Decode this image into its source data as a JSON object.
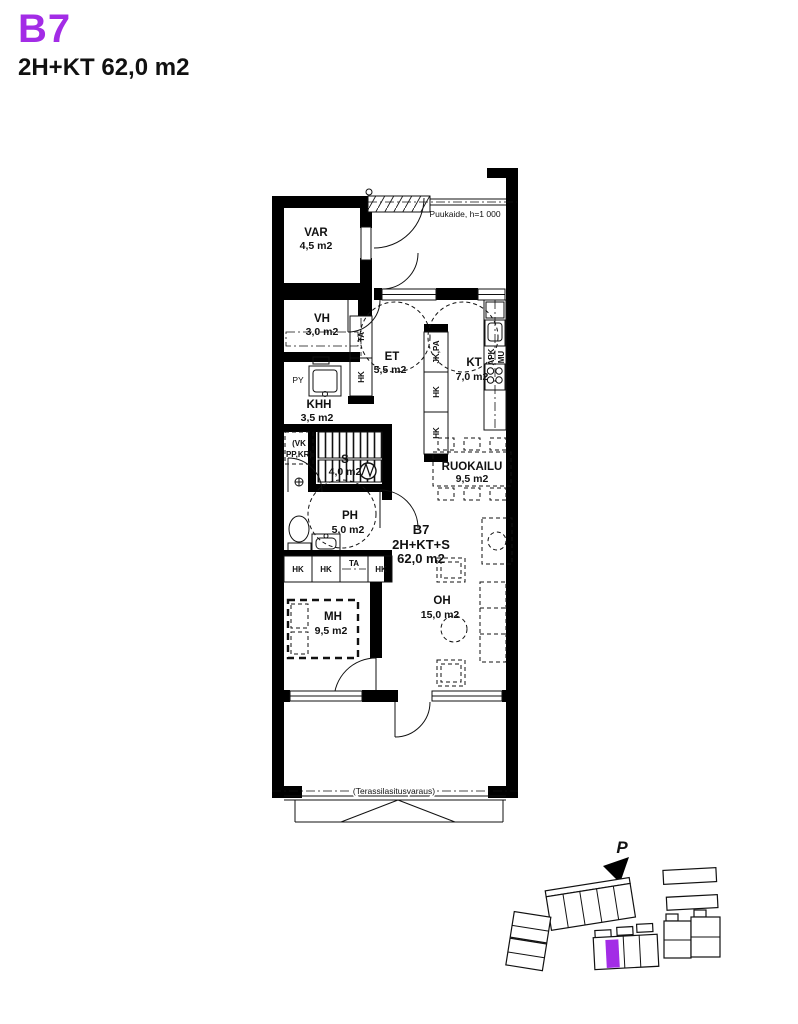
{
  "header": {
    "unit_id": "B7",
    "unit_spec": "2H+KT 62,0 m2"
  },
  "colors": {
    "accent": "#a32ce6",
    "wall": "#000000"
  },
  "floorplan": {
    "rooms": [
      {
        "name": "VAR",
        "area": "4,5 m2"
      },
      {
        "name": "VH",
        "area": "3,0 m2"
      },
      {
        "name": "ET",
        "area": "5,5 m2"
      },
      {
        "name": "KT",
        "area": "7,0 m2"
      },
      {
        "name": "KHH",
        "area": "3,5 m2"
      },
      {
        "name": "S",
        "area": "4,0 m2"
      },
      {
        "name": "PH",
        "area": "5,0 m2"
      },
      {
        "name": "RUOKAILU",
        "area": "9,5 m2"
      },
      {
        "name": "OH",
        "area": "15,0 m2"
      },
      {
        "name": "MH",
        "area": "9,5 m2"
      }
    ],
    "unit_label": {
      "line1": "B7",
      "line2": "2H+KT+S",
      "line3": "62,0 m2"
    },
    "annotations": {
      "railing": "Puukaide, h=1 000",
      "terrace_glazing": "(Terassilasitusvaraus)"
    },
    "fixtures": {
      "py": "PY",
      "vk_line1": "(VK",
      "vk_line2": "PP,KR)",
      "ta": "TA",
      "hk": "HK",
      "jk_pa": "JK,PA",
      "apk": "APK",
      "mu": "MU",
      "closet_row": [
        "HK",
        "HK",
        "TA",
        "HK"
      ]
    }
  },
  "siteplan": {
    "north": "P"
  }
}
